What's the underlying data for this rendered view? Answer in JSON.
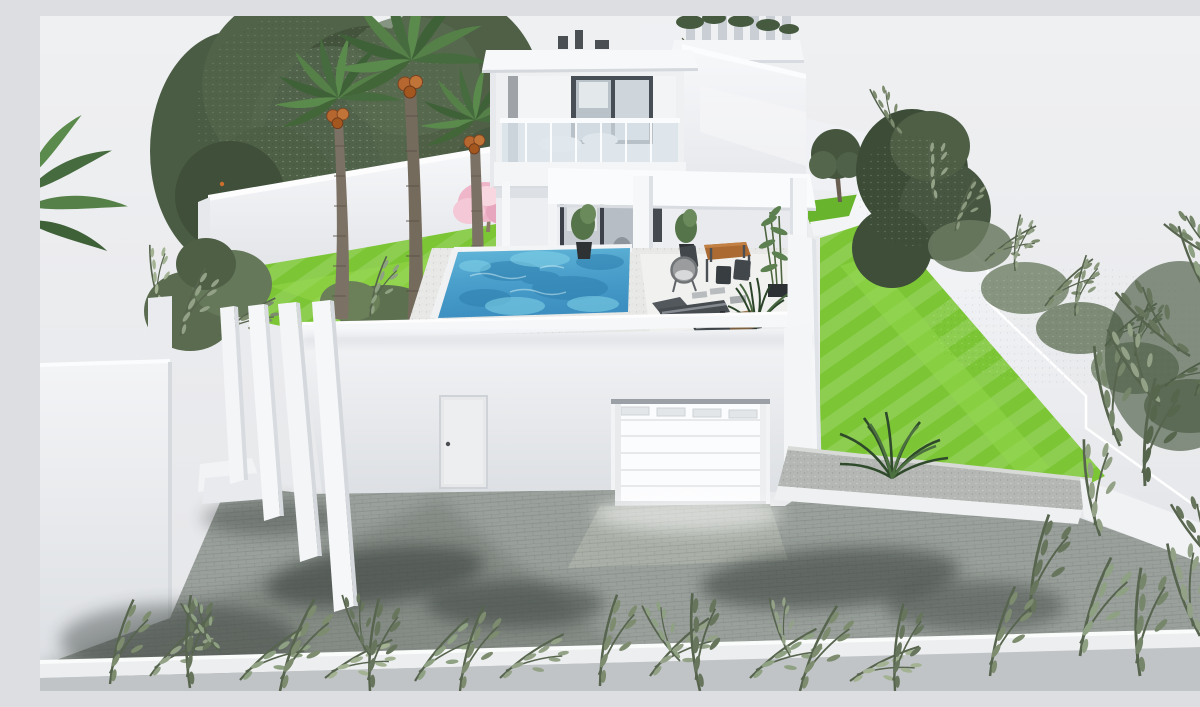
{
  "scene": {
    "type": "3d-architectural-exterior-render",
    "subject": "modern two-story white villa with pool, palm garden and walled yard",
    "view": "aerial-three-quarter-view",
    "lighting": "daylight",
    "palette": {
      "bg": "#eaebed",
      "white-bright": "#f8f9fb",
      "white-face": "#eef0f3",
      "white-shade": "#dfe2e7",
      "pool-light": "#7fd0e6",
      "pool-mid": "#4a9fcb",
      "pool-deep": "#2e7fae",
      "lawn": "#7cc636",
      "lawn-deep": "#66b42a",
      "foliage-dark": "#43533c",
      "foliage-mid": "#5d7150",
      "foliage-olive": "#7d8c6e",
      "blossom": "#efb6c9",
      "fruit": "#b5672f",
      "trunk": "#7b7164",
      "wood": "#aa6a31",
      "metal-dark": "#42474c",
      "pavement": "#9aa09b",
      "pavement-dark": "#7e847f",
      "street": "#c1c4c7",
      "curb": "#eceeef",
      "gravel": "#b4b7b3",
      "glass": "#d7e2e8",
      "frame-dark": "#484e55",
      "shadow": "#2a332e"
    },
    "elements": [
      "modern-two-story-villa",
      "rooftop-slat-pergola",
      "balcony-glass-railing",
      "upper-sliding-door",
      "swimming-pool",
      "pool-deck",
      "covered-terrace",
      "terrace-columns",
      "outdoor-dining-set",
      "wicker-chair",
      "sun-loungers",
      "potted-plants",
      "bamboo-plants",
      "date-palm-trees",
      "orange-trees",
      "pink-blossom-tree",
      "left-boundary-wall",
      "right-boundary-wall",
      "hedge",
      "rear-garden-tree",
      "right-lawn",
      "left-garden-lawn",
      "entrance-fins",
      "entry-steps",
      "entry-door",
      "garage-door",
      "driveway-ramp",
      "paved-court",
      "gravel-planter",
      "cycad-palm",
      "foreground-shrubs",
      "street-curb",
      "street"
    ]
  }
}
